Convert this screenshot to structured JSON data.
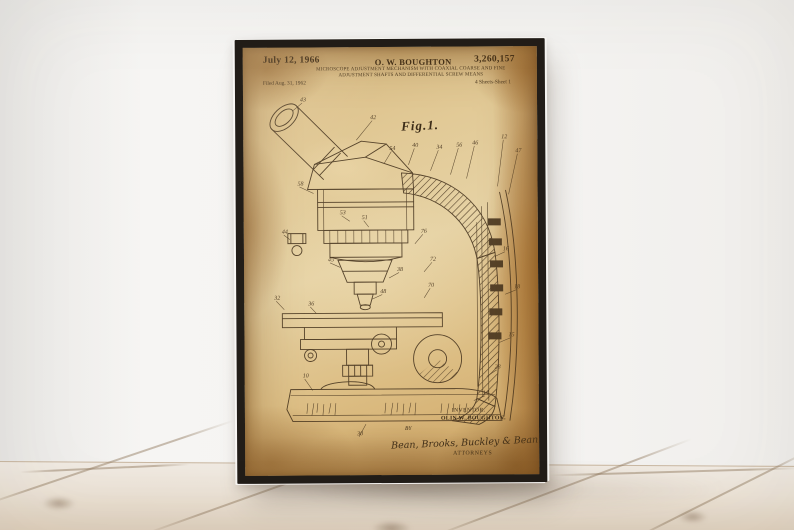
{
  "poster": {
    "header": {
      "date": "July 12, 1966",
      "inventor": "O. W. BOUGHTON",
      "patent_number": "3,260,157",
      "title_line1": "MICROSCOPE ADJUSTMENT MECHANISM WITH COAXIAL COARSE AND FINE",
      "title_line2": "ADJUSTMENT SHAFTS AND DIFFERENTIAL SCREW MEANS",
      "filed": "Filed Aug. 31, 1962",
      "sheet": "4 Sheets-Sheet 1"
    },
    "figure_label": "Fig.1.",
    "footer": {
      "inventor_caption": "INVENTOR.",
      "inventor_name": "OLIN W. BOUGHTON.",
      "by_label": "BY",
      "signature": "Bean, Brooks, Buckley & Bean",
      "attorneys_label": "ATTORNEYS"
    },
    "reference_numerals": [
      {
        "n": "43",
        "x": 57,
        "y": 54,
        "lx": 50,
        "ly": 63
      },
      {
        "n": "42",
        "x": 127,
        "y": 72,
        "lx": 113,
        "ly": 93
      },
      {
        "n": "54",
        "x": 146,
        "y": 103,
        "lx": 141,
        "ly": 116
      },
      {
        "n": "40",
        "x": 169,
        "y": 100,
        "lx": 165,
        "ly": 118
      },
      {
        "n": "34",
        "x": 193,
        "y": 102,
        "lx": 187,
        "ly": 124
      },
      {
        "n": "56",
        "x": 213,
        "y": 100,
        "lx": 207,
        "ly": 128
      },
      {
        "n": "46",
        "x": 229,
        "y": 98,
        "lx": 223,
        "ly": 132
      },
      {
        "n": "12",
        "x": 258,
        "y": 92,
        "lx": 254,
        "ly": 140
      },
      {
        "n": "47",
        "x": 272,
        "y": 106,
        "lx": 265,
        "ly": 148
      },
      {
        "n": "58",
        "x": 54,
        "y": 138,
        "lx": 70,
        "ly": 146
      },
      {
        "n": "53",
        "x": 96,
        "y": 167,
        "lx": 106,
        "ly": 174
      },
      {
        "n": "51",
        "x": 118,
        "y": 172,
        "lx": 125,
        "ly": 180
      },
      {
        "n": "44",
        "x": 38,
        "y": 186,
        "lx": 46,
        "ly": 192
      },
      {
        "n": "45",
        "x": 84,
        "y": 214,
        "lx": 96,
        "ly": 220
      },
      {
        "n": "48",
        "x": 136,
        "y": 246,
        "lx": 128,
        "ly": 252
      },
      {
        "n": "38",
        "x": 153,
        "y": 224,
        "lx": 145,
        "ly": 231
      },
      {
        "n": "32",
        "x": 30,
        "y": 252,
        "lx": 40,
        "ly": 262
      },
      {
        "n": "36",
        "x": 64,
        "y": 258,
        "lx": 72,
        "ly": 266
      },
      {
        "n": "76",
        "x": 177,
        "y": 186,
        "lx": 171,
        "ly": 197
      },
      {
        "n": "72",
        "x": 186,
        "y": 214,
        "lx": 180,
        "ly": 225
      },
      {
        "n": "70",
        "x": 184,
        "y": 240,
        "lx": 180,
        "ly": 251
      },
      {
        "n": "16",
        "x": 259,
        "y": 204,
        "lx": 251,
        "ly": 210
      },
      {
        "n": "18",
        "x": 270,
        "y": 242,
        "lx": 261,
        "ly": 248
      },
      {
        "n": "15",
        "x": 264,
        "y": 290,
        "lx": 255,
        "ly": 296
      },
      {
        "n": "28",
        "x": 250,
        "y": 322,
        "lx": 242,
        "ly": 330
      },
      {
        "n": "14",
        "x": 238,
        "y": 348,
        "lx": 229,
        "ly": 354
      },
      {
        "n": "10",
        "x": 58,
        "y": 330,
        "lx": 68,
        "ly": 343
      },
      {
        "n": "30",
        "x": 112,
        "y": 388,
        "lx": 121,
        "ly": 377
      }
    ]
  },
  "colors": {
    "frame": "#221d18",
    "paper_light": "#e6d2a4",
    "paper_mid": "#d8ba82",
    "paper_dark": "#9e7036",
    "ink": "#43311c",
    "wall": "#f4f3f1",
    "floor_light": "#f0eae2",
    "floor_dark": "#dccbb6"
  }
}
